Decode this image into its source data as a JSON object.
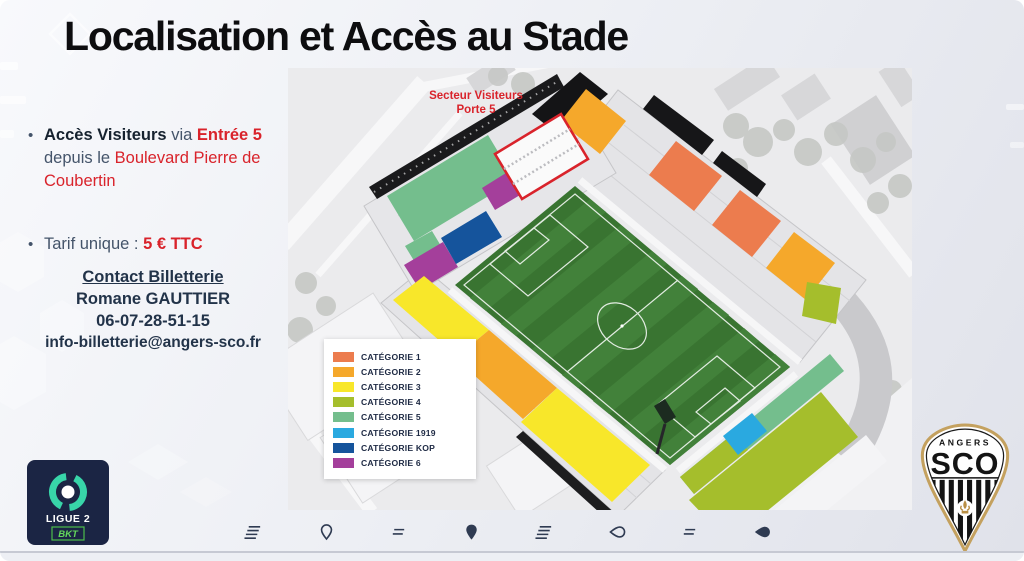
{
  "slide": {
    "title": "Localisation et Accès au Stade",
    "access": {
      "bold": "Accès Visiteurs",
      "mid": " via ",
      "entrance": "Entrée 5",
      "mid2": " depuis le ",
      "street": "Boulevard Pierre de Coubertin"
    },
    "tarif": {
      "label": "Tarif unique : ",
      "price": "5 € TTC"
    },
    "contact": {
      "heading": "Contact Billetterie",
      "name": "Romane GAUTTIER",
      "phone": "06-07-28-51-15",
      "email": "info-billetterie@angers-sco.fr"
    }
  },
  "map": {
    "sector_label": {
      "line1": "Secteur Visiteurs",
      "line2": "Porte 5"
    },
    "legend": [
      {
        "label": "CATÉGORIE 1",
        "color": "#EC7C4E"
      },
      {
        "label": "CATÉGORIE 2",
        "color": "#F5A82B"
      },
      {
        "label": "CATÉGORIE 3",
        "color": "#F8E72A"
      },
      {
        "label": "CATÉGORIE 4",
        "color": "#A5BE2C"
      },
      {
        "label": "CATÉGORIE 5",
        "color": "#74BE8D"
      },
      {
        "label": "CATÉGORIE 1919",
        "color": "#2AA9E0"
      },
      {
        "label": "CATÉGORIE KOP",
        "color": "#15549C"
      },
      {
        "label": "CATÉGORIE 6",
        "color": "#A43F9B"
      }
    ]
  },
  "logos": {
    "ligue2": {
      "name": "Ligue 2 BKT",
      "line1": "LIGUE 2",
      "line2": "BKT"
    },
    "sco": {
      "name": "Angers SCO",
      "top": "ANGERS",
      "main": "SCO"
    }
  },
  "footer_icons": [
    "speed-lines",
    "map-pin-outline",
    "equals-lines",
    "map-pin-filled",
    "speed-lines",
    "drop-outline",
    "equals-lines",
    "drop-filled"
  ],
  "colors": {
    "accent_red": "#D9232B",
    "text_dark": "#44546A",
    "contact_navy": "#223349",
    "title_black": "#0d0d0f",
    "pitch_green": "#397431"
  }
}
